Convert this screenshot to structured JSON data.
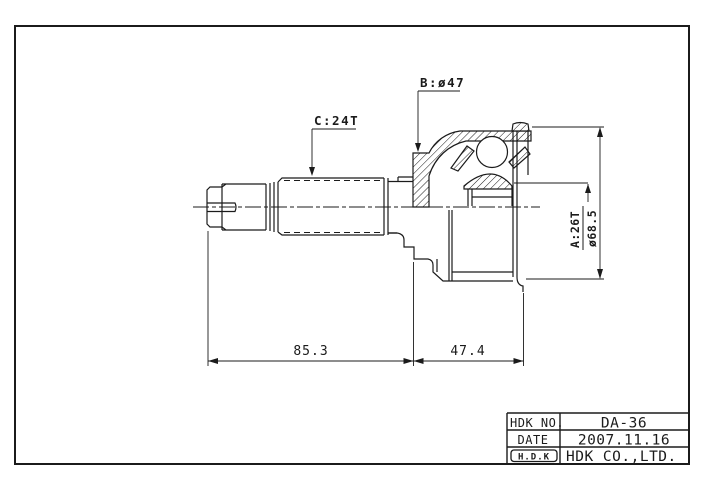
{
  "style": {
    "background": "#ffffff",
    "line_color": "#1b1b1b"
  },
  "drawing": {
    "type": "technical-drawing",
    "subject": "outboard CV joint with splined shaft, half-section view",
    "labels": {
      "b": "B:ø47",
      "c": "C:24T",
      "a_spline": "A:26T",
      "a_diameter": "ø68.5"
    },
    "dimensions": {
      "length_left": "85.3",
      "length_right": "47.4"
    }
  },
  "title_block": {
    "rows": [
      {
        "label": "HDK NO.",
        "value": "DA-36"
      },
      {
        "label": "DATE",
        "value": "2007.11.16"
      },
      {
        "label": "H.D.K",
        "value": "HDK CO.,LTD."
      }
    ]
  }
}
